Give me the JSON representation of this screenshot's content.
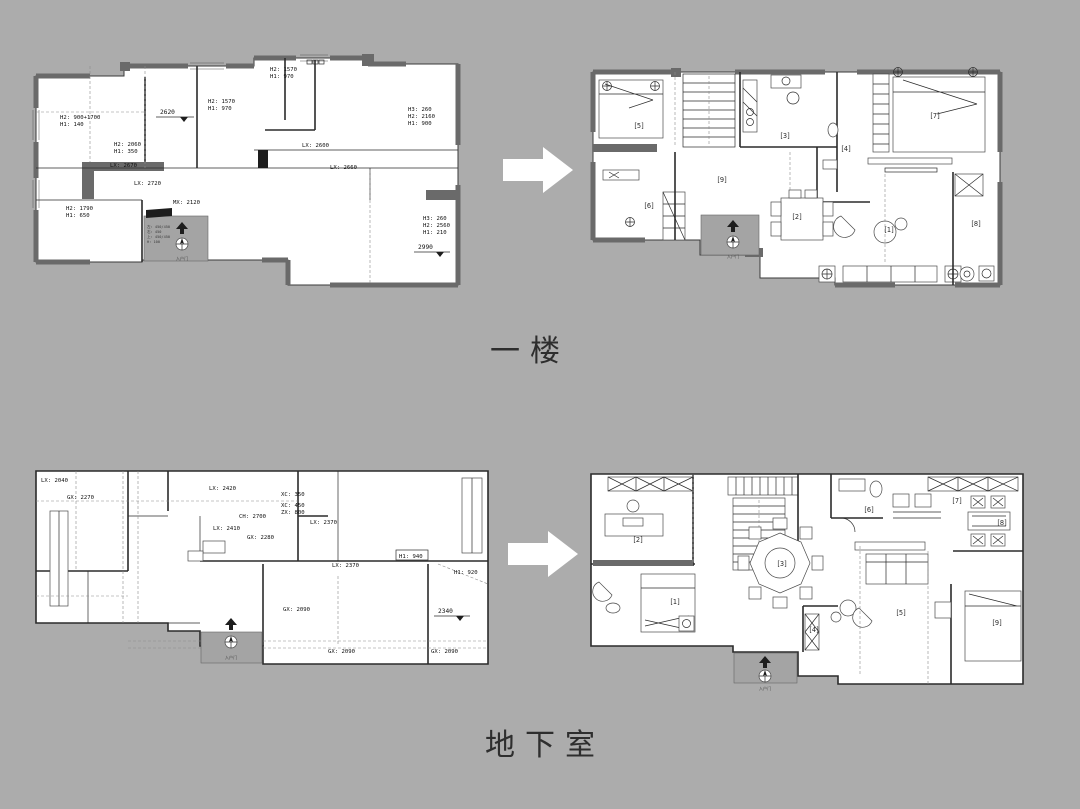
{
  "page": {
    "background": "#acacac"
  },
  "colors": {
    "wall": "#6a6a6a",
    "floor": "#ffffff",
    "line": "#2b2b2b",
    "arrow": "#ffffff"
  },
  "titles": {
    "first_floor": "一楼",
    "basement": "地下室"
  },
  "entrance_label": "入户门",
  "plans": {
    "ffb": {
      "labels": [
        {
          "t": "H2: 900+1700"
        },
        {
          "t": "H1: 140"
        },
        {
          "t": "H2: 2060"
        },
        {
          "t": "H1: 350"
        },
        {
          "t": "H2: 1570"
        },
        {
          "t": "H1: 970"
        },
        {
          "t": "H2: 1570"
        },
        {
          "t": "H1: 970"
        },
        {
          "t": "LX: 2600"
        },
        {
          "t": "LX: 2660"
        },
        {
          "t": "H3: 260"
        },
        {
          "t": "H2: 2160"
        },
        {
          "t": "H1: 900"
        },
        {
          "t": "LX: 2670"
        },
        {
          "t": "LX: 2720"
        },
        {
          "t": "MX: 2120"
        },
        {
          "t": "H2: 1790"
        },
        {
          "t": "H1: 650"
        },
        {
          "t": "H3: 260"
        },
        {
          "t": "H2: 2560"
        },
        {
          "t": "H1: 210"
        }
      ],
      "levels": [
        {
          "t": "2620"
        },
        {
          "t": "2990"
        }
      ],
      "entry_notes": [
        {
          "t": "左: 450/450"
        },
        {
          "t": "右: 450"
        },
        {
          "t": "上: 450/450"
        },
        {
          "t": "H: 100"
        }
      ]
    },
    "ffa": {
      "rooms": [
        {
          "n": "[1]"
        },
        {
          "n": "[2]"
        },
        {
          "n": "[3]"
        },
        {
          "n": "[4]"
        },
        {
          "n": "[5]"
        },
        {
          "n": "[6]"
        },
        {
          "n": "[7]"
        },
        {
          "n": "[8]"
        },
        {
          "n": "[9]"
        }
      ]
    },
    "bfb": {
      "labels": [
        {
          "t": "LX: 2040"
        },
        {
          "t": "GX: 2270"
        },
        {
          "t": "LX: 2420"
        },
        {
          "t": "CH: 2700"
        },
        {
          "t": "LX: 2410"
        },
        {
          "t": "GX: 2280"
        },
        {
          "t": "XC: 350"
        },
        {
          "t": "XC: 450"
        },
        {
          "t": "ZX: 800"
        },
        {
          "t": "LX: 2370"
        },
        {
          "t": "LX: 2370"
        },
        {
          "t": "H1: 940"
        },
        {
          "t": "H1: 920"
        },
        {
          "t": "GX: 2090"
        },
        {
          "t": "GX: 2090"
        },
        {
          "t": "GX: 2090"
        }
      ],
      "levels": [
        {
          "t": "2340"
        }
      ]
    },
    "bfa": {
      "rooms": [
        {
          "n": "[1]"
        },
        {
          "n": "[2]"
        },
        {
          "n": "[3]"
        },
        {
          "n": "[4]"
        },
        {
          "n": "[5]"
        },
        {
          "n": "[6]"
        },
        {
          "n": "[7]"
        },
        {
          "n": "[8]"
        },
        {
          "n": "[9]"
        }
      ]
    }
  }
}
